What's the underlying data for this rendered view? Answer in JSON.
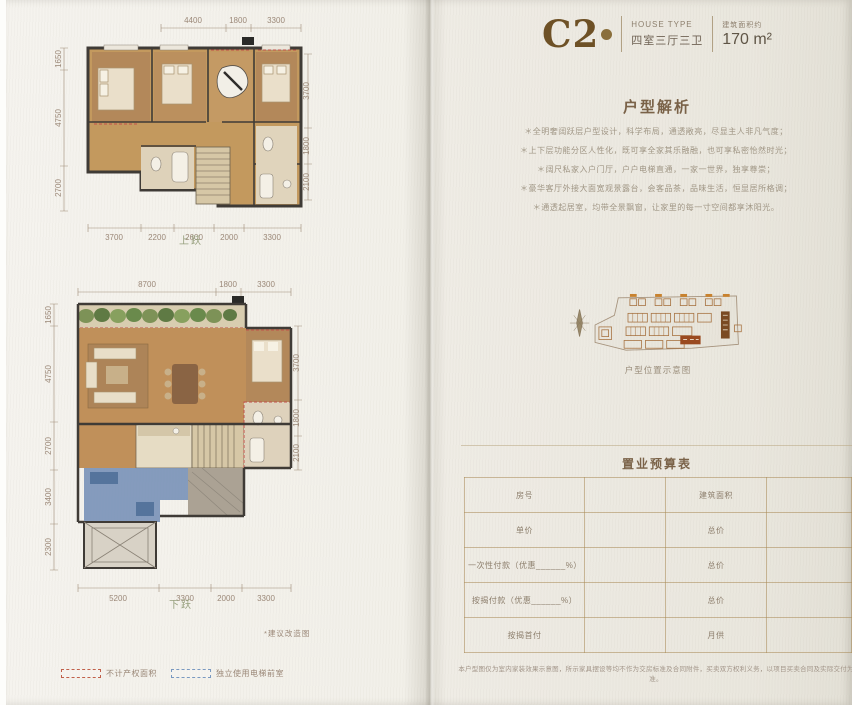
{
  "header": {
    "unit_code": "C2",
    "house_type_label": "HOUSE TYPE",
    "house_type_value": "四室三厅三卫",
    "area_label": "建筑面积约",
    "area_value": "170 m²"
  },
  "analysis": {
    "title": "户型解析",
    "bullets": [
      "＊全明奢阔跃层户型设计，科学布局，通透敞亮，尽显主人非凡气度；",
      "＊上下层功能分区人性化，既可享全家其乐融融，也可享私密怡然时光；",
      "＊阔尺私家入户门厅，户户电梯直通，一家一世界，独享尊崇；",
      "＊豪华客厅外接大面宽观景露台，会客品茶，品味生活，恒显居所格调；",
      "＊通透起居室，均带全景飘窗，让家里的每一寸空间都享沐阳光。"
    ]
  },
  "location": {
    "caption": "户型位置示意图"
  },
  "budget": {
    "title": "置业预算表",
    "rows": [
      {
        "left": "房号",
        "right": "建筑面积"
      },
      {
        "left": "单价",
        "right": "总价"
      },
      {
        "left": "一次性付款（优惠______%）",
        "right": "总价"
      },
      {
        "left": "按揭付款（优惠______%）",
        "right": "总价"
      },
      {
        "left": "按揭首付",
        "right": "月供"
      }
    ],
    "disclaimer": "本户型图仅为室内家装效果示意图，所示家具摆设等均不作为交房标准及合同附件，买卖双方权利义务，以项目买卖合同及实际交付为准。"
  },
  "plans": {
    "note": "*建议改造图",
    "upper": {
      "label": "上跃",
      "dims_top": [
        "4400",
        "1800",
        "3300"
      ],
      "dims_left": [
        "1650",
        "4750",
        "2700"
      ],
      "dims_right": [
        "3700",
        "1800",
        "2100"
      ],
      "dims_bottom": [
        "3700",
        "2200",
        "2600",
        "2000",
        "3300"
      ]
    },
    "lower": {
      "label": "下跃",
      "dims_top": [
        "8700",
        "1800",
        "3300"
      ],
      "dims_left": [
        "1650",
        "4750",
        "2700",
        "3400",
        "2300"
      ],
      "dims_right": [
        "3700",
        "1800",
        "2100"
      ],
      "dims_bottom": [
        "5200",
        "3300",
        "2000",
        "3300"
      ]
    }
  },
  "legend": {
    "items": [
      {
        "label": "不计产权面积"
      },
      {
        "label": "独立使用电梯前室"
      }
    ]
  },
  "colors": {
    "accent_bronze": "#6e5126",
    "title_brown": "#7a6248",
    "wall_dark": "#3f3b36",
    "wood_floor": "#c0905a",
    "dash_red": "#c0504a",
    "zone_blue": "#7b94b8",
    "table_line": "#aa8a58"
  }
}
